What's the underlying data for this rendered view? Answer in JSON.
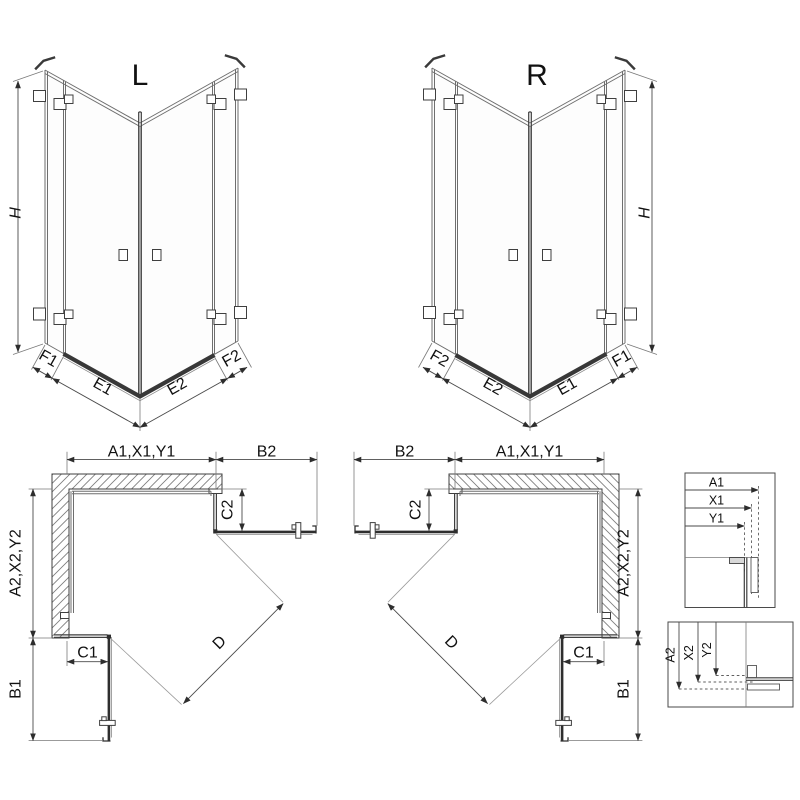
{
  "drawing": {
    "iso_left": {
      "label": "L",
      "height": "H",
      "widths": [
        "F1",
        "E1",
        "E2",
        "F2"
      ]
    },
    "iso_right": {
      "label": "R",
      "height": "H",
      "widths": [
        "F2",
        "E2",
        "E1",
        "F1"
      ]
    },
    "plan_left": {
      "width_top": "A1,X1,Y1",
      "door_top": "B2",
      "panel_top": "C2",
      "depth_side": "A2,X2,Y2",
      "panel_side": "C1",
      "door_side": "B1",
      "diagonal": "D"
    },
    "plan_right": {
      "width_top": "A1,X1,Y1",
      "door_top": "B2",
      "panel_top": "C2",
      "depth_side": "A2,X2,Y2",
      "panel_side": "C1",
      "door_side": "B1",
      "diagonal": "D"
    },
    "detail_width": {
      "labels": [
        "A1",
        "X1",
        "Y1"
      ]
    },
    "detail_depth": {
      "labels": [
        "A2",
        "X2",
        "Y2"
      ]
    }
  }
}
